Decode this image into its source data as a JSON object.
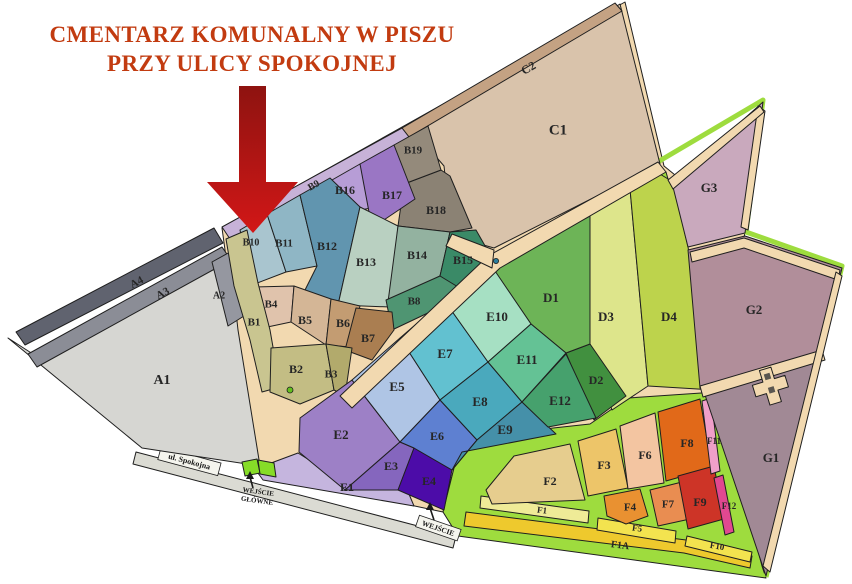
{
  "title": {
    "line1": "CMENTARZ KOMUNALNY W PISZU",
    "line2": "PRZY ULICY SPOKOJNEJ",
    "color": "#c23b10"
  },
  "street": {
    "label": "ul. Spokojna"
  },
  "entrance_main": {
    "line1": "WEJŚCIE",
    "line2": "GŁÓWNE"
  },
  "entrance_side": {
    "label": "WEJŚCIE"
  },
  "colors": {
    "path_tan": "#f2d9b0",
    "path_green": "#9edc3e",
    "entrance_green": "#86dc28",
    "street_gray": "#dbdbd3",
    "street_label_bg": "#f5f5ee",
    "arrow_dark": "#8e1310",
    "arrow_bright": "#d21717",
    "dot_blue": "#2a7d9c",
    "dot_green": "#63c01f",
    "cross_fill": "#f2d9b0"
  },
  "sections": [
    {
      "id": "A1",
      "label": "A1",
      "color": "#d6d6d2"
    },
    {
      "id": "A2",
      "label": "A2",
      "color": "#9597a0"
    },
    {
      "id": "A3",
      "label": "A3",
      "color": "#8b8d96"
    },
    {
      "id": "A4",
      "label": "A4",
      "color": "#60636f"
    },
    {
      "id": "B1",
      "label": "B1",
      "color": "#c9c590"
    },
    {
      "id": "B2",
      "label": "B2",
      "color": "#c3bd84"
    },
    {
      "id": "B3",
      "label": "B3",
      "color": "#b2aa6c"
    },
    {
      "id": "B4",
      "label": "B4",
      "color": "#e0c3ac"
    },
    {
      "id": "B5",
      "label": "B5",
      "color": "#d4b696"
    },
    {
      "id": "B6",
      "label": "B6",
      "color": "#c39c72"
    },
    {
      "id": "B7",
      "label": "B7",
      "color": "#aa7e51"
    },
    {
      "id": "B8",
      "label": "B8",
      "color": "#4f9572"
    },
    {
      "id": "B9",
      "label": "B9",
      "color": "#c7b2d8"
    },
    {
      "id": "B10",
      "label": "B10",
      "color": "#a9c5cf"
    },
    {
      "id": "B11",
      "label": "B11",
      "color": "#8fb6c5"
    },
    {
      "id": "B12",
      "label": "B12",
      "color": "#6195af"
    },
    {
      "id": "B13",
      "label": "B13",
      "color": "#b9d0c1"
    },
    {
      "id": "B14",
      "label": "B14",
      "color": "#93b2a0"
    },
    {
      "id": "B15",
      "label": "B15",
      "color": "#3a8a67"
    },
    {
      "id": "B16",
      "label": "B16",
      "color": "#b79dd6"
    },
    {
      "id": "B17",
      "label": "B17",
      "color": "#9a76c4"
    },
    {
      "id": "B18",
      "label": "B18",
      "color": "#8b8274"
    },
    {
      "id": "B19",
      "label": "B19",
      "color": "#948a7b"
    },
    {
      "id": "C1",
      "label": "C1",
      "color": "#d9c3ab"
    },
    {
      "id": "C2",
      "label": "C2",
      "color": "#c4a283"
    },
    {
      "id": "D1",
      "label": "D1",
      "color": "#6db457"
    },
    {
      "id": "D2",
      "label": "D2",
      "color": "#41903f"
    },
    {
      "id": "D3",
      "label": "D3",
      "color": "#dde58b"
    },
    {
      "id": "D4",
      "label": "D4",
      "color": "#bdd34c"
    },
    {
      "id": "E1",
      "label": "E1",
      "color": "#c5b5de"
    },
    {
      "id": "E2",
      "label": "E2",
      "color": "#9d80c6"
    },
    {
      "id": "E3",
      "label": "E3",
      "color": "#8566be"
    },
    {
      "id": "E4",
      "label": "E4",
      "color": "#4c0ca8"
    },
    {
      "id": "E5",
      "label": "E5",
      "color": "#afc5e5"
    },
    {
      "id": "E6",
      "label": "E6",
      "color": "#5e80d1"
    },
    {
      "id": "E7",
      "label": "E7",
      "color": "#62c1d0"
    },
    {
      "id": "E8",
      "label": "E8",
      "color": "#4aa9bd"
    },
    {
      "id": "E9",
      "label": "E9",
      "color": "#4590a9"
    },
    {
      "id": "E10",
      "label": "E10",
      "color": "#a6e0c3"
    },
    {
      "id": "E11",
      "label": "E11",
      "color": "#64c295"
    },
    {
      "id": "E12",
      "label": "E12",
      "color": "#46a16d"
    },
    {
      "id": "F1",
      "label": "F1",
      "color": "#efeb97"
    },
    {
      "id": "F1A",
      "label": "F1A",
      "color": "#eec92d"
    },
    {
      "id": "F2",
      "label": "F2",
      "color": "#e6cd8e"
    },
    {
      "id": "F3",
      "label": "F3",
      "color": "#edc569"
    },
    {
      "id": "F4",
      "label": "F4",
      "color": "#e99131"
    },
    {
      "id": "F5",
      "label": "F5",
      "color": "#f3e34f"
    },
    {
      "id": "F6",
      "label": "F6",
      "color": "#f3c5a1"
    },
    {
      "id": "F7",
      "label": "F7",
      "color": "#e98d51"
    },
    {
      "id": "F8",
      "label": "F8",
      "color": "#e16919"
    },
    {
      "id": "F9",
      "label": "F9",
      "color": "#cd3427"
    },
    {
      "id": "F10",
      "label": "F10",
      "color": "#f3e34f"
    },
    {
      "id": "F11",
      "label": "F11",
      "color": "#ef9fc9"
    },
    {
      "id": "F12",
      "label": "F12",
      "color": "#e14890"
    },
    {
      "id": "G1",
      "label": "G1",
      "color": "#a18995"
    },
    {
      "id": "G2",
      "label": "G2",
      "color": "#b18e9a"
    },
    {
      "id": "G3",
      "label": "G3",
      "color": "#c9a9bd"
    }
  ]
}
